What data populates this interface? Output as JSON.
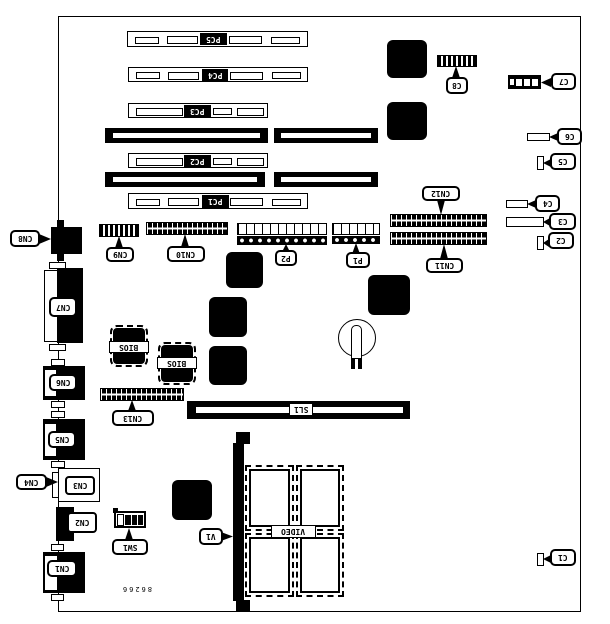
{
  "diagram": {
    "part_number": "86266",
    "labels": {
      "pc1": "PC1",
      "pc2": "PC2",
      "pc3": "PC3",
      "pc4": "PC4",
      "pc5": "PC5",
      "cn1": "CN1",
      "cn2": "CN2",
      "cn3": "CN3",
      "cn4": "CN4",
      "cn5": "CN5",
      "cn6": "CN6",
      "cn7": "CN7",
      "cn8": "CN8",
      "cn9": "CN9",
      "cn10": "CN10",
      "cn11": "CN11",
      "cn12": "CN12",
      "cn13": "CN13",
      "c1": "C1",
      "c2": "C2",
      "c3": "C3",
      "c4": "C4",
      "c5": "C5",
      "c6": "C6",
      "c7": "C7",
      "c8": "C8",
      "p1": "P1",
      "p2": "P2",
      "sl1": "SL1",
      "sw1": "SW1",
      "v1": "V1",
      "video": "VIDEO",
      "bios": "BIOS"
    }
  }
}
